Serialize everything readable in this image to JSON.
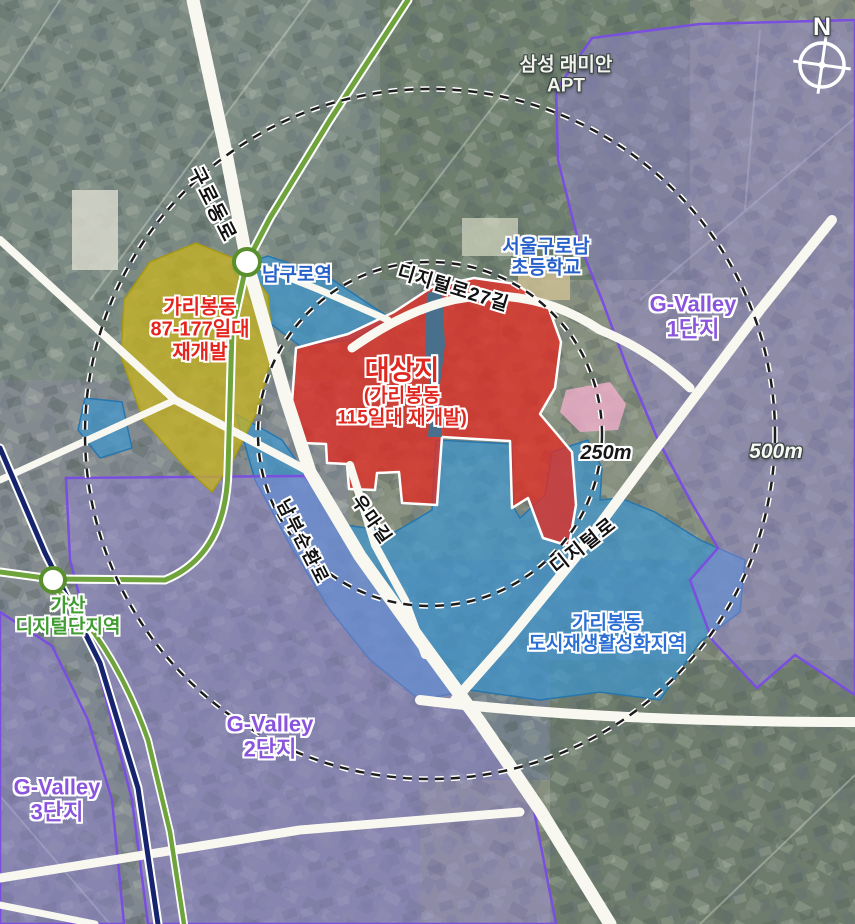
{
  "map": {
    "compass": {
      "north_label": "N"
    },
    "rings": {
      "inner_label": "250m",
      "outer_label": "500m"
    },
    "stations": {
      "namguro": {
        "name": "남구로역"
      },
      "gasan": {
        "line1": "가산",
        "line2": "디지털단지역"
      }
    },
    "roads": {
      "guro_dong_ro": "구로동로",
      "digital_ro_27gil": "디지털로27길",
      "nambu_sunhwan_ro": "남부순환로",
      "uma_gil": "우마길",
      "digital_ro": "디지털로"
    },
    "areas": {
      "samsung_apt": {
        "line1": "삼성 래미안",
        "line2": "APT"
      },
      "garibong_87": {
        "line1": "가리봉동",
        "line2": "87-177일대",
        "line3": "재개발"
      },
      "target_site": {
        "line1": "대상지",
        "line2": "(가리봉동",
        "line3": "115일대 재개발)"
      },
      "seoul_guronam_school": {
        "line1": "서울구로남",
        "line2": "초등학교"
      },
      "gvalley1": {
        "line1": "G-Valley",
        "line2": "1단지"
      },
      "garibong_urban_regen": {
        "line1": "가리봉동",
        "line2": "도시재생활성화지역"
      },
      "gvalley2": {
        "line1": "G-Valley",
        "line2": "2단지"
      },
      "gvalley3": {
        "line1": "G-Valley",
        "line2": "3단지"
      }
    },
    "colors": {
      "zone_red": "#e12d24",
      "zone_yellow": "#c8b31d",
      "zone_blue": "#3e96cd",
      "zone_purple": "#9484d8",
      "zone_pink": "#f0aecb",
      "label_red": "#e5251d",
      "label_blue": "#2660c8",
      "label_purple": "#8a55dc",
      "label_green": "#3f9c30",
      "subway_green": "#6fa33c",
      "subway_navy": "#16246e"
    }
  }
}
